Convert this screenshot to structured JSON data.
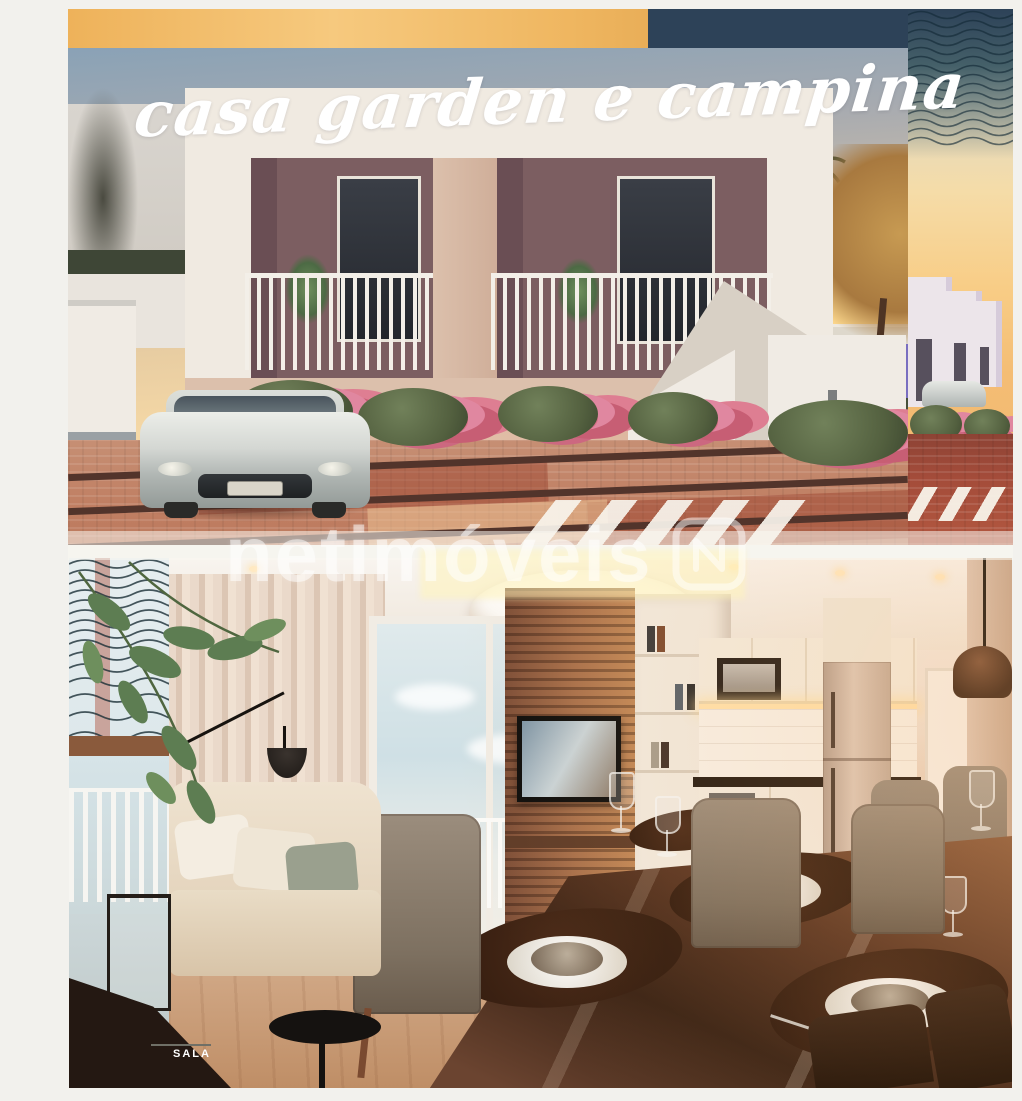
{
  "page": {
    "background": "#f2f1ed"
  },
  "exterior_photo": {
    "title_overlay": "casa garden e campina"
  },
  "interior_photo": {
    "room_label": "SALA"
  },
  "watermark": {
    "text": "netimóveis",
    "logo_icon": "netimoveis-logo"
  },
  "colors": {
    "accent_orange": "#f1b963",
    "accent_navy": "#2d4258",
    "wave_teal": "#2f4f59",
    "brick_red": "#a44c3a",
    "sunset_gold": "#f6cd88",
    "sky_blue": "#8aa2b6",
    "interior_wood": "#a9714c",
    "watermark_white": "rgba(255,255,255,0.52)"
  }
}
